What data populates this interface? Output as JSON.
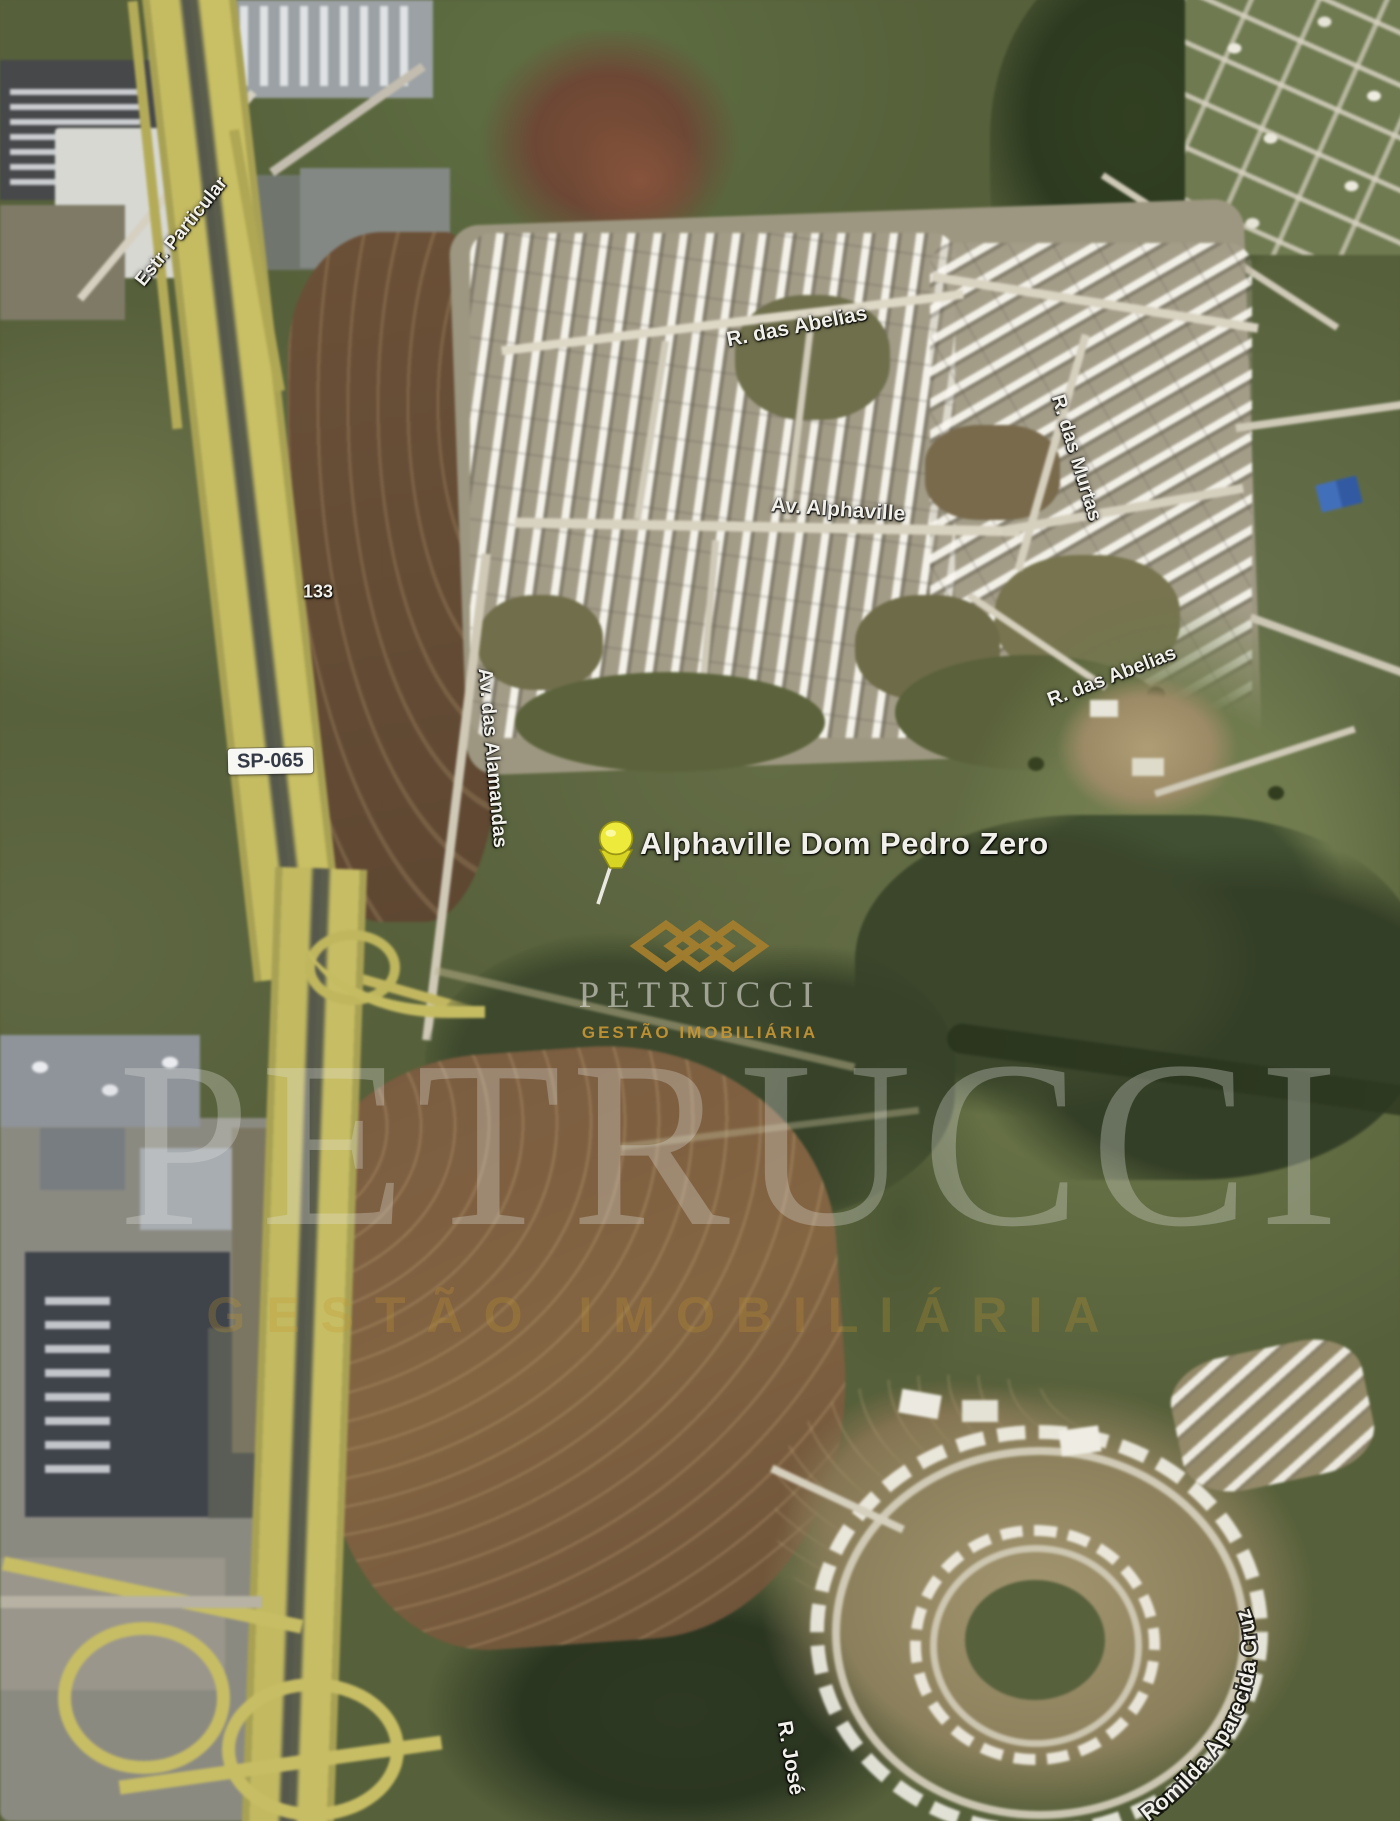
{
  "map": {
    "marker": {
      "title": "Alphaville Dom Pedro Zero",
      "icon": "yellow-pushpin-icon"
    },
    "route_shields": [
      {
        "label": "SP-065"
      },
      {
        "label": "133"
      }
    ],
    "road_labels": [
      {
        "name": "estr-particular",
        "text": "Estr. Particular"
      },
      {
        "name": "r-das-abelias-north",
        "text": "R. das Abelias"
      },
      {
        "name": "av-alphaville",
        "text": "Av. Alphaville"
      },
      {
        "name": "r-das-murtas",
        "text": "R. das Murtas"
      },
      {
        "name": "av-das-alamandas",
        "text": "Av. das Alamandas"
      },
      {
        "name": "r-das-abelias-east",
        "text": "R. das Abelias"
      },
      {
        "name": "romilda-aparecida-cruz",
        "text": "Romilda Aparecida Cruz"
      },
      {
        "name": "r-jose",
        "text": "R. José"
      }
    ]
  },
  "watermarks": {
    "logo": {
      "icon": "petrucci-diamond-logo-icon",
      "brand": "PETRUCCI",
      "tagline": "GESTÃO IMOBILIÁRIA"
    },
    "big_brand": "PETRUCCI",
    "big_tagline": "GESTÃO IMOBILIÁRIA"
  },
  "colors": {
    "brand_gold": "#a8802d",
    "highway_yellow": "#c6bc5c",
    "marker_yellow": "#ebe93a",
    "label_white": "#f2f0ea"
  }
}
